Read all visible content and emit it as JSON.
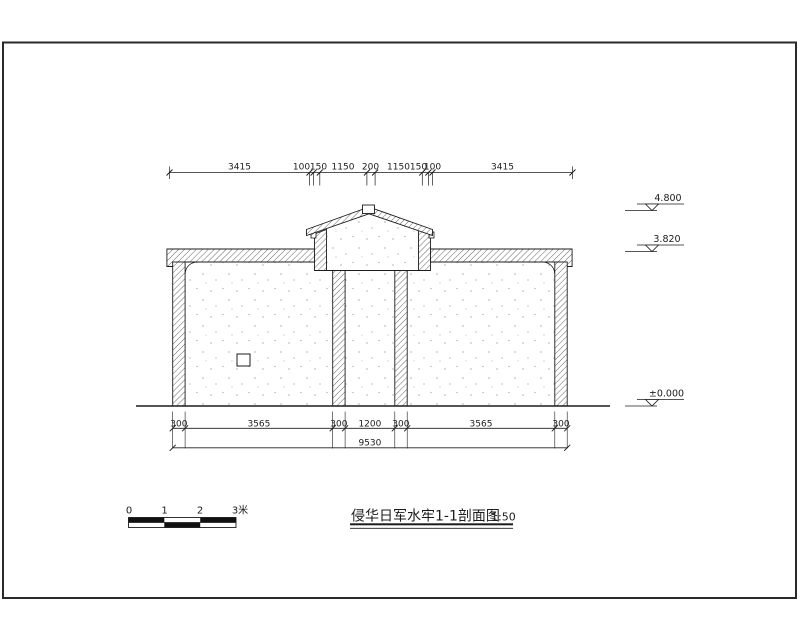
{
  "drawing": {
    "title": "侵华日军水牢1-1剖面图",
    "scale": "1:50"
  },
  "dims": {
    "top": [
      "3415",
      "100",
      "150",
      "1150",
      "200",
      "1150",
      "150",
      "100",
      "3415"
    ],
    "bottom": [
      "300",
      "3565",
      "300",
      "1200",
      "300",
      "3565",
      "300"
    ],
    "total": "9530"
  },
  "elev": {
    "ridge": "4.800",
    "eave": "3.820",
    "ground": "±0.000"
  },
  "scalebar": {
    "labels": [
      "0",
      "1",
      "2",
      "3米"
    ]
  },
  "colors": {
    "ink": "#1c1c1c",
    "stipple_dot": "#909090",
    "paper": "#ffffff"
  }
}
